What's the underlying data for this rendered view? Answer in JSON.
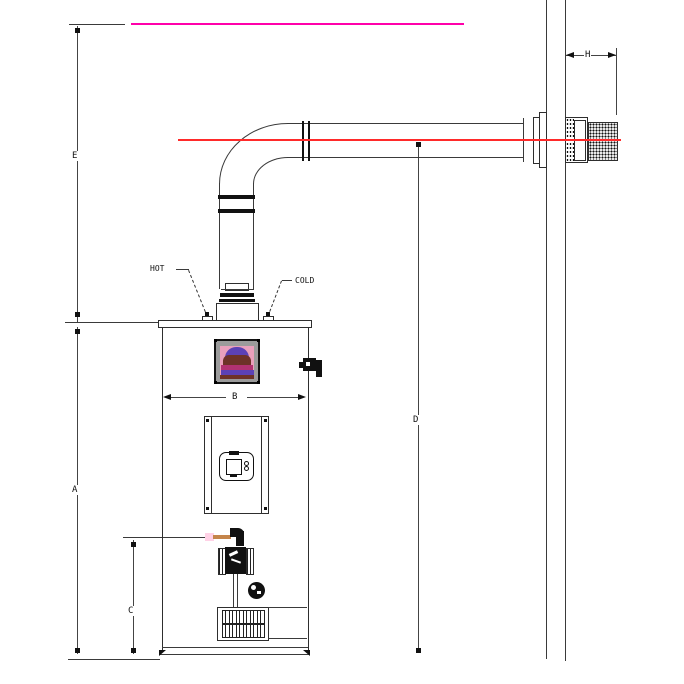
{
  "diagram": {
    "dim_labels": {
      "A": "A",
      "B": "B",
      "C": "C",
      "D": "D",
      "E": "E",
      "H": "H"
    },
    "pipe_labels": {
      "hot": "HOT",
      "cold": "COLD"
    },
    "colors": {
      "magenta_reference_line": "#ff00aa",
      "red_centerline": "#ff2a2a",
      "gas_pipe": "#c5854a",
      "gas_pipe_glow": "#ffd2e6",
      "warning_label_bg": "#9b9b9b",
      "warning_label_pink": "#e9a0bc",
      "warning_label_maroon": "#6e3228",
      "warning_label_magenta": "#b23272",
      "warning_label_purple": "#5c41b6",
      "line_color": "#333333"
    }
  }
}
